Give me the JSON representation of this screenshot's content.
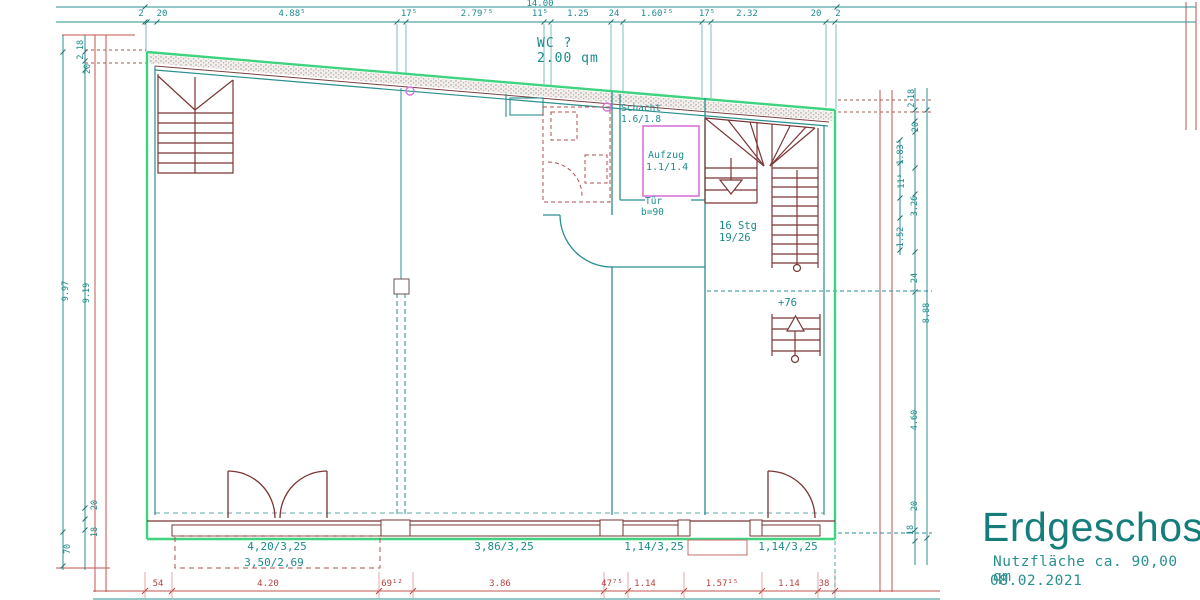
{
  "title_block": {
    "title": "Erdgeschoss",
    "area_note": "Nutzfläche ca. 90,00 qm",
    "date": "08.02.2021"
  },
  "annotations": {
    "wc": [
      "WC ?",
      "2.00 qm"
    ],
    "schacht": [
      "Schacht",
      "1.6/1.8"
    ],
    "aufzug": [
      "Aufzug",
      "1.1/1.4"
    ],
    "tuer": [
      "Tür",
      "b=90"
    ],
    "stair": [
      "16 Stg",
      "19/26"
    ],
    "level_mark": "+76"
  },
  "bottom_room_labels": [
    "4,20/3,25",
    "3,50/2,69",
    "3,86/3,25",
    "1,14/3,25",
    "1,14/3,25"
  ],
  "dim_top": {
    "overall": "14.00",
    "segments": [
      "2",
      "20",
      "4.88⁵",
      "17⁵",
      "2.79⁷⁵",
      "11⁵",
      "1.25",
      "24",
      "1.60²⁵",
      "17⁵",
      "2.32",
      "20",
      "2"
    ]
  },
  "dim_bottom": {
    "segments": [
      "54",
      "4.20",
      "69¹²",
      "3.86",
      "47⁷⁵",
      "1.14",
      "1.57¹⁵",
      "1.14",
      "38"
    ]
  },
  "dim_left": {
    "labels": [
      "18",
      "2",
      "20",
      "9.97",
      "9.19",
      "20",
      "18",
      "70"
    ]
  },
  "dim_right": {
    "labels": [
      "18",
      "2",
      "20",
      "1.83⁵",
      "11⁵",
      "3.26",
      "1.52",
      "24",
      "8.88",
      "4.60",
      "20",
      "18"
    ]
  },
  "colors": {
    "dimension_red": "#c4554f",
    "cad_teal": "#1d8b8b",
    "outline_green": "#3fd37f",
    "stair_dark_red": "#7a3535",
    "elevator_magenta": "#d873d8",
    "title_teal": "#157d7b"
  }
}
